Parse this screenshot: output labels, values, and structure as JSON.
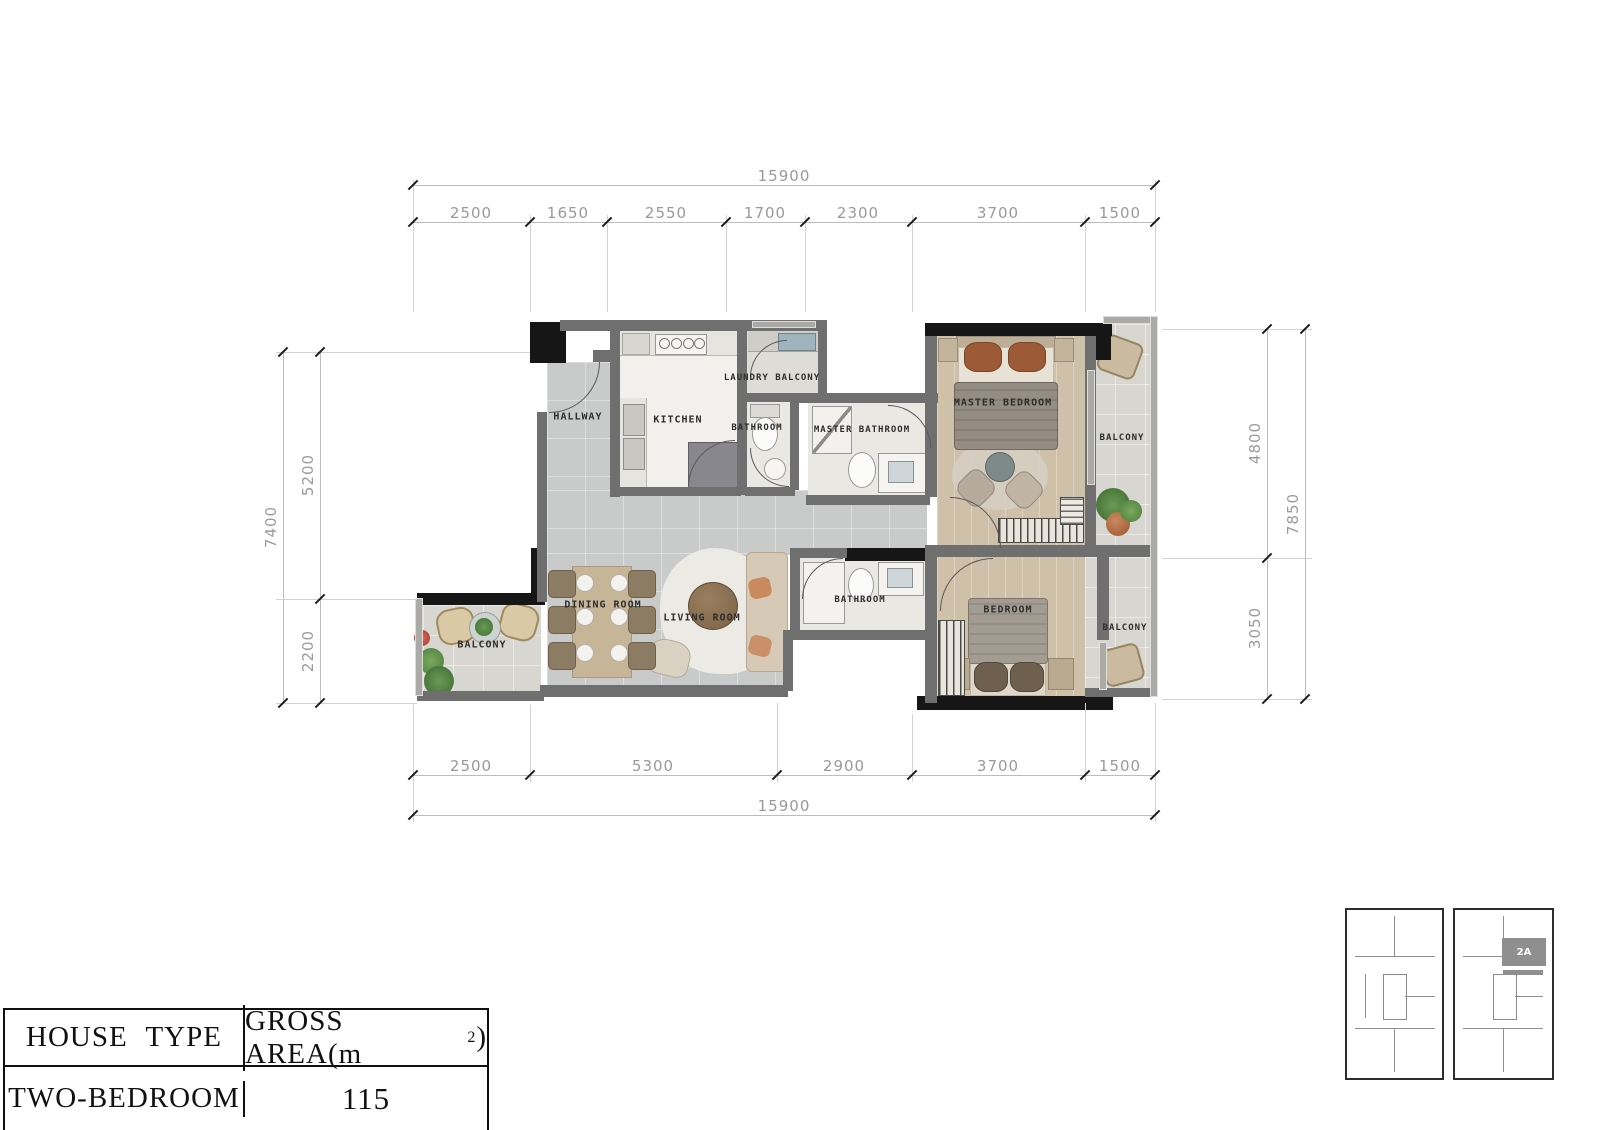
{
  "floor_plan": {
    "rooms": {
      "hallway": "HALLWAY",
      "kitchen": "KITCHEN",
      "laundry_balcony": "LAUNDRY BALCONY",
      "bathroom_upper": "BATHROOM",
      "master_bathroom": "MASTER BATHROOM",
      "master_bedroom": "MASTER BEDROOM",
      "balcony_upper_right": "BALCONY",
      "dining_room": "DINING ROOM",
      "living_room": "LIVING ROOM",
      "balcony_left": "BALCONY",
      "bathroom_lower": "BATHROOM",
      "bedroom": "BEDROOM",
      "balcony_lower_right": "BALCONY"
    },
    "dimensions": {
      "top": {
        "total": "15900",
        "segments": [
          "2500",
          "1650",
          "2550",
          "1700",
          "2300",
          "3700",
          "1500"
        ]
      },
      "bottom": {
        "total": "15900",
        "segments": [
          "2500",
          "5300",
          "2900",
          "3700",
          "1500"
        ]
      },
      "left": {
        "total": "7400",
        "segments": [
          "5200",
          "2200"
        ]
      },
      "right": {
        "total": "7850",
        "segments": [
          "4800",
          "3050"
        ]
      }
    }
  },
  "info_table": {
    "house_type_header": "HOUSE TYPE",
    "gross_area_prefix": "GROSS AREA(m",
    "gross_area_sup": "2",
    "gross_area_suffix": ")",
    "house_type_value": "TWO-BEDROOM",
    "gross_area_value": "115"
  },
  "key_plan": {
    "unit_label": "2A"
  },
  "colors": {
    "wall": "#6f6f6f",
    "wall_black": "#161616",
    "tile_floor": "#c9cbca",
    "wood_floor": "#cfc0a9",
    "bath_floor": "#eae8e3",
    "balcony_floor": "#d8d6d0",
    "dim_text": "#9a9a9a",
    "highlight_unit": "#8f8f8f"
  }
}
